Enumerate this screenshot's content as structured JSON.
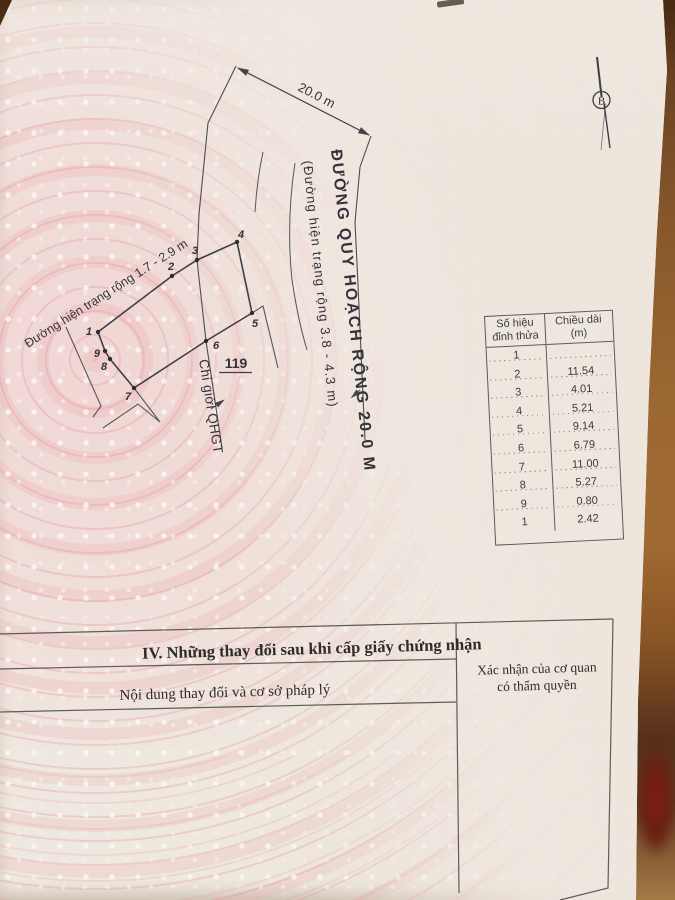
{
  "compass": {
    "north_label": "B"
  },
  "map": {
    "dimension_label": "20.0 m",
    "planned_road_label": "ĐƯỜNG QUY HOẠCH RỘNG 20.0 M",
    "planned_road_sublabel": "(Đường hiện trạng rộng 3.8 - 4.3 m)",
    "existing_road_label": "Đường hiện trạng rộng 1.7 - 2.9 m",
    "boundary_label": "Chỉ giới QHGT",
    "parcel_number": "119",
    "vertex_labels": [
      "1",
      "2",
      "3",
      "4",
      "5",
      "6",
      "7",
      "8",
      "9"
    ]
  },
  "vertex_table": {
    "header": {
      "col1_line1": "Số hiệu",
      "col1_line2": "đỉnh thửa",
      "col2_line1": "Chiều dài",
      "col2_line2": "(m)"
    },
    "rows": [
      {
        "vertex": "1",
        "length": ""
      },
      {
        "vertex": "2",
        "length": "11.54"
      },
      {
        "vertex": "3",
        "length": "4.01"
      },
      {
        "vertex": "4",
        "length": "5.21"
      },
      {
        "vertex": "5",
        "length": "9.14"
      },
      {
        "vertex": "6",
        "length": "6.79"
      },
      {
        "vertex": "7",
        "length": "11.00"
      },
      {
        "vertex": "8",
        "length": "5.27"
      },
      {
        "vertex": "9",
        "length": "0.80"
      },
      {
        "vertex": "1",
        "length": "2.42"
      }
    ]
  },
  "section_iv": {
    "title": "IV. Những thay đổi sau khi cấp giấy chứng nhận",
    "left_header": "Nội dung thay đổi và cơ sở pháp lý",
    "right_header_line1": "Xác nhận của cơ quan",
    "right_header_line2": "có thẩm quyền"
  },
  "colors": {
    "paper": "#efe8e0",
    "watermark_pink": "#f0c8ca",
    "line": "#44444a",
    "table_brown": "#8a5a2c"
  }
}
